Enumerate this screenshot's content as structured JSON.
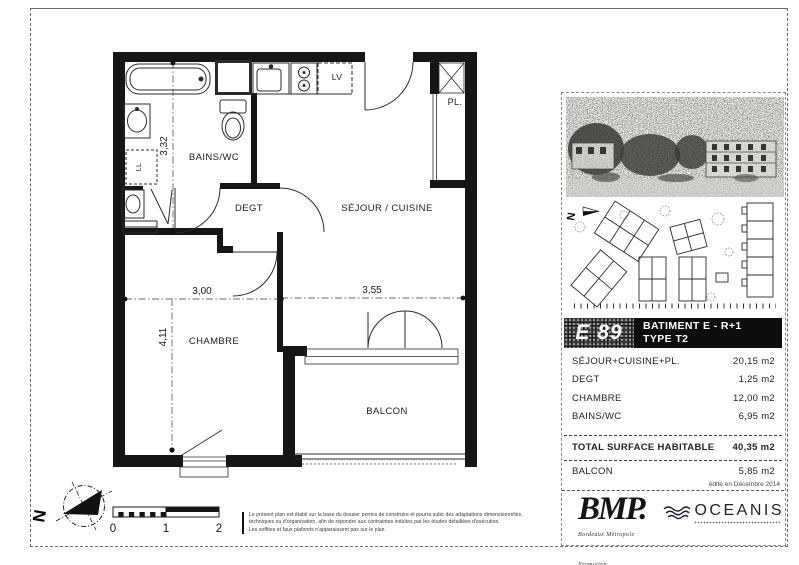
{
  "plan": {
    "room_labels": {
      "bains": "BAINS/WC",
      "degt": "DEGT",
      "sejour": "SÉJOUR / CUISINE",
      "chambre": "CHAMBRE",
      "balcon": "BALCON",
      "placard": "PL.",
      "lave_vaisselle": "LV",
      "lave_linge": "LL"
    },
    "dimensions": {
      "bains_height": "3,32",
      "chambre_width": "3,00",
      "sejour_width": "3,55",
      "chambre_height": "4,11"
    },
    "north_letter": "N",
    "scale_labels": [
      "0",
      "1",
      "2"
    ]
  },
  "panel": {
    "unit_code": "E 89",
    "building_line1": "BATIMENT E - R+1",
    "building_line2": "TYPE T2",
    "surface_rows": [
      {
        "label": "SÉJOUR+CUISINE+PL.",
        "value": "20,15 m2"
      },
      {
        "label": "DEGT",
        "value": "1,25 m2"
      },
      {
        "label": "CHAMBRE",
        "value": "12,00 m2"
      },
      {
        "label": "BAINS/WC",
        "value": "6,95 m2"
      }
    ],
    "total_row": {
      "label": "TOTAL SURFACE HABITABLE",
      "value": "40,35 m2"
    },
    "balcony_row": {
      "label": "BALCON",
      "value": "5,85 m2"
    },
    "edition_note": "édité en Décembre 2014"
  },
  "footer": {
    "disclaimer_lines": [
      "Le présent plan est établi sur la base du dossier permis de construire et pourra subir des adaptations dimensionnelles,",
      "techniques ou d'organisation, afin de répondre aux contraintes induites par les études détaillées d'exécution.",
      "Les soffites et faux plafonds n'apparaissent pas sur le plan."
    ],
    "bmp_name": "BMP.",
    "bmp_tagline": "Bordeaux Métropole Promotion",
    "oceanis_name": "OCEANIS"
  }
}
